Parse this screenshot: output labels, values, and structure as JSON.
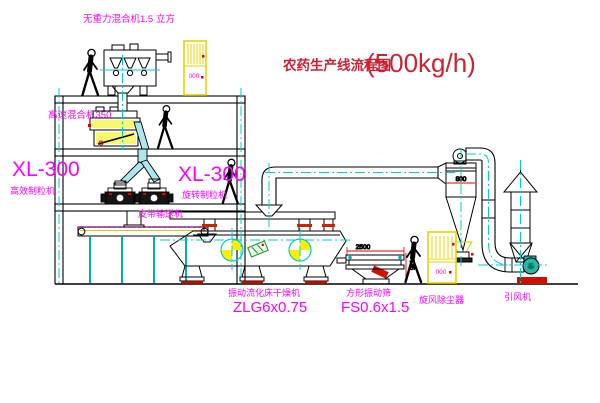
{
  "title": {
    "text": "农药生产线流程图",
    "capacity": "(500kg/h)"
  },
  "labels": {
    "gravity_mixer": "无重力混合机1.5 立方",
    "high_speed_mixer": "高速混合机350",
    "granulator_left_model": "XL-300",
    "granulator_left_name": "高效制粒机",
    "granulator_right_model": "XL-300",
    "granulator_right_name": "旋转制粒机",
    "belt_conveyor": "皮带输送机",
    "dryer_name": "振动流化床干燥机",
    "dryer_model": "ZLG6x0.75",
    "screen_name": "方形振动筛",
    "screen_model": "FS0.6x1.5",
    "cyclone": "旋风除尘器",
    "fan": "引风机"
  },
  "dimensions": {
    "cyclone_inlet": "800",
    "screen_length": "2500",
    "screen_height": "745"
  },
  "cabinets": {
    "top_display": "000",
    "bottom_display": "000"
  },
  "colors": {
    "line": "#000000",
    "centerline": "#00cccc",
    "label_magenta": "#ff00ff",
    "title_red": "#cc2233",
    "cabinet_yellow": "#e8d400",
    "accent_red": "#dd0000",
    "logo_green": "#1a8a1a",
    "fan_teal": "#2ab5a5",
    "chute_cyan": "#aee6ef"
  }
}
